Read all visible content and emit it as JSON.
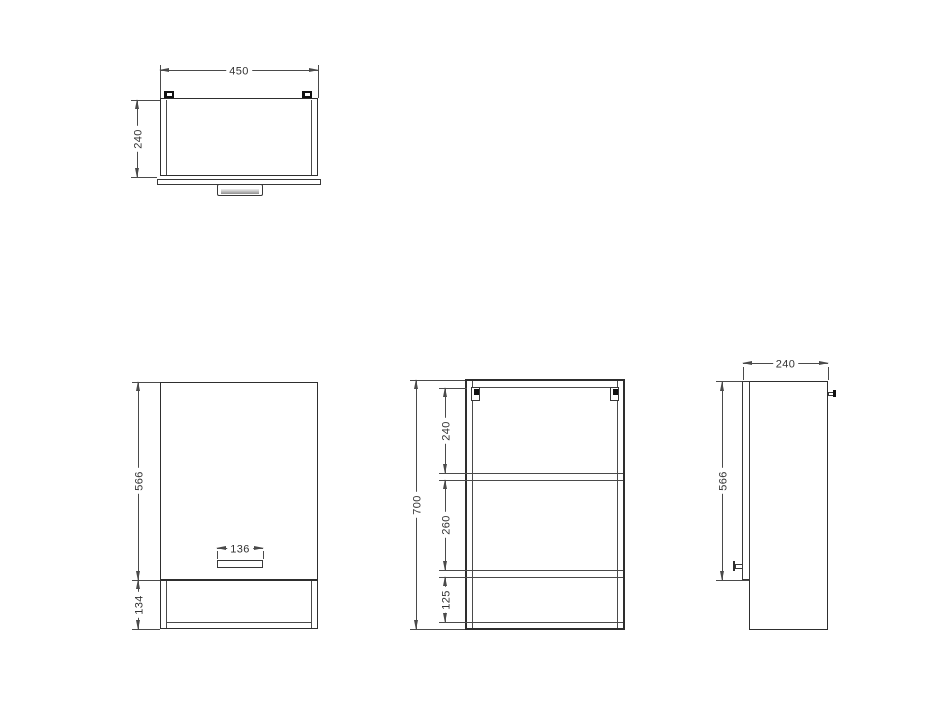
{
  "dims": {
    "top": {
      "width": "450",
      "depth": "240"
    },
    "front": {
      "door_height": "566",
      "base_height": "134",
      "handle_width": "136"
    },
    "section": {
      "total_height": "700",
      "seg_top": "240",
      "seg_mid": "260",
      "seg_bottom": "125"
    },
    "side": {
      "depth": "240",
      "door_height": "566"
    }
  }
}
